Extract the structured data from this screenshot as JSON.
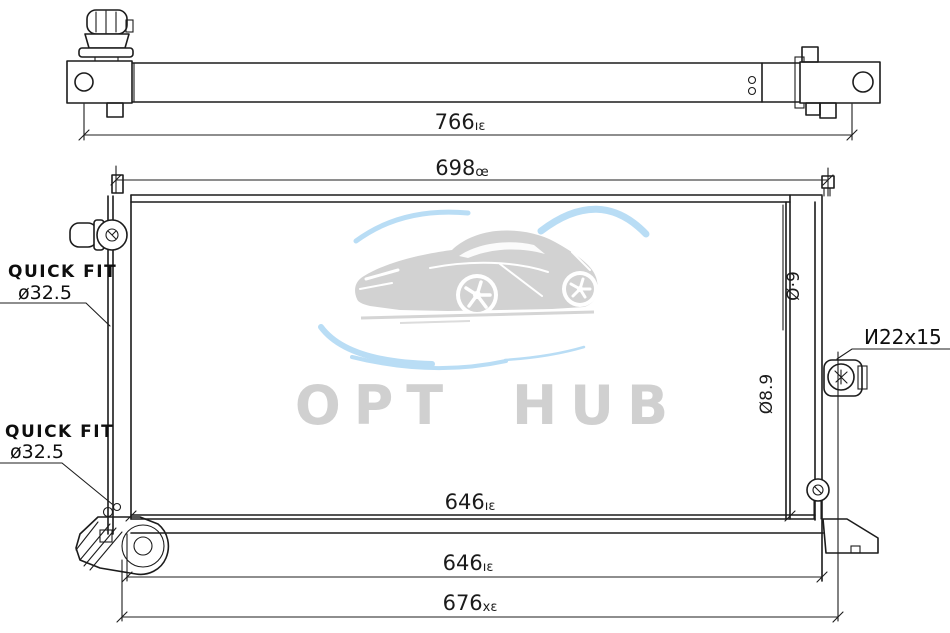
{
  "drawing": {
    "type": "radiator technical drawing, top view and front view"
  },
  "watermark": {
    "brand": "OPT HUB"
  },
  "dimensions": {
    "top_view_width": {
      "value": "766",
      "suffix": "ıɛ"
    },
    "upper_width": {
      "value": "698",
      "suffix": "œ"
    },
    "core_width": {
      "value": "646",
      "suffix": "ıɛ"
    },
    "lower_width": {
      "value": "646",
      "suffix": "ıɛ"
    },
    "overall_width": {
      "value": "676",
      "suffix": "xɛ"
    },
    "right_upper_rotated": "Ø·9",
    "right_lower_rotated": "Ø8.9"
  },
  "labels": {
    "quick_fit_upper": {
      "title": "QUICK FIT",
      "size": "ø32.5"
    },
    "quick_fit_lower": {
      "title": "QUICK FIT",
      "size": "ø32.5"
    },
    "thread_spec": "И22x15"
  },
  "colors": {
    "line": "#1c1c1c",
    "watermark_gray": "#d2d2d2",
    "watermark_blue": "#b9ddf5"
  }
}
